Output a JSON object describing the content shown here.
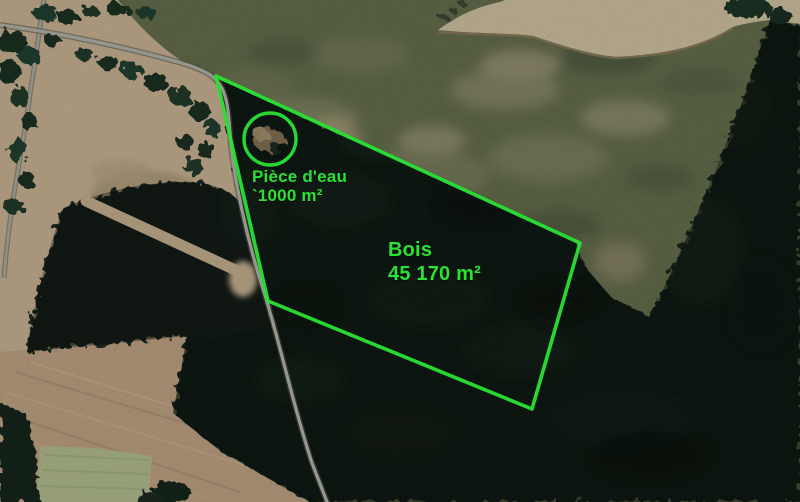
{
  "map": {
    "annotation_color": "#28e334",
    "palette": {
      "forest": "#18271e",
      "forest_block": "#1b2b20",
      "meadow": "#656e4c",
      "field_tan_left": "#c8b293",
      "field_tan_right": "#cfc2a1",
      "field_band": "#bfa284",
      "field_pale_green": "#b2bc8e",
      "road": "#b2b3a9"
    },
    "annotations": {
      "pond": {
        "label_line1": "Pièce d'eau",
        "label_line2": "`1000 m²",
        "circle": {
          "cx": 270,
          "cy": 139,
          "r": 26
        }
      },
      "woods": {
        "label_line1": "Bois",
        "label_line2": "45 170 m²",
        "polygon_points": "216,76 580,243 532,409 268,301"
      }
    }
  }
}
